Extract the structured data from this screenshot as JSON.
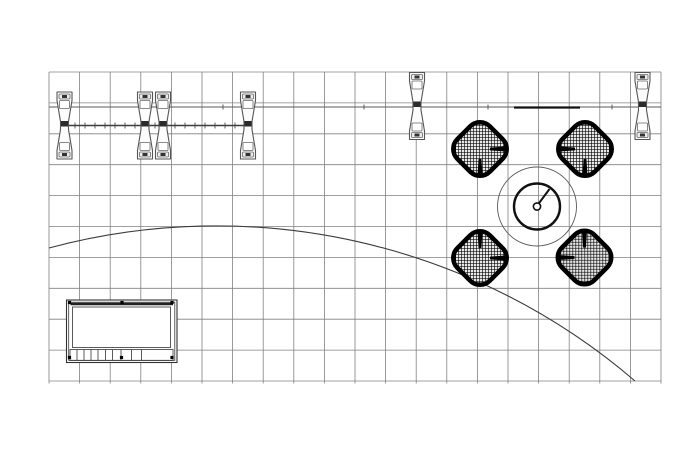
{
  "meta": {
    "type": "cad-floor-plan",
    "description": "Top view exhibit booth furniture plan on square grid",
    "background": "#ffffff"
  },
  "canvas": {
    "width": 700,
    "height": 450
  },
  "colors": {
    "grid": "#818181",
    "line": "#3c3c3c",
    "line_light": "#5a5a5a",
    "dark": "#111111",
    "fill": "#ffffff",
    "stool_fill": "#fcfcfc",
    "stool_inner": "#ececec",
    "mesh_bg": "#e8e8e8"
  },
  "grid": {
    "x": 49,
    "y": 72,
    "cols": 20,
    "rows": 10,
    "cell_w": 30.6,
    "cell_h": 30.9,
    "overhang": 2.5
  },
  "wall_line": {
    "y": 107,
    "x1": 49,
    "x2": 661,
    "ticks": [
      223,
      364,
      488,
      612
    ],
    "tick_h": 5
  },
  "counter_line": {
    "y": 125.5,
    "x1": 61,
    "x2": 249,
    "tick_start": 75,
    "tick_end": 245,
    "tick_step": 10,
    "tick_h": 6
  },
  "header_bar": {
    "y": 107.5,
    "x1": 514,
    "x2": 580
  },
  "stools": [
    {
      "cx": 64.5,
      "cy": 125.5
    },
    {
      "cx": 145,
      "cy": 125.5
    },
    {
      "cx": 163,
      "cy": 125.5
    },
    {
      "cx": 248,
      "cy": 125.5
    },
    {
      "cx": 417,
      "cy": 106
    },
    {
      "cx": 642.5,
      "cy": 106
    }
  ],
  "table": {
    "cx": 537,
    "cy": 206.5,
    "outer_r": 39.5,
    "inner_r": 23,
    "hub_r": 3.6,
    "hand_x2": 549.5,
    "hand_y2": 189
  },
  "lounge_chairs": [
    {
      "cx": 480,
      "cy": 149,
      "face_x": 1,
      "face_y": 1
    },
    {
      "cx": 585,
      "cy": 149,
      "face_x": -1,
      "face_y": 1
    },
    {
      "cx": 480,
      "cy": 258,
      "face_x": 1,
      "face_y": -1
    },
    {
      "cx": 584.5,
      "cy": 257.5,
      "face_x": -1,
      "face_y": -1
    }
  ],
  "cabinet": {
    "x": 66.5,
    "y": 300,
    "w": 110.5,
    "h": 62.5,
    "inner_inset": 2.2,
    "top_bar_y": 304,
    "panel": {
      "x": 72.5,
      "y": 307,
      "w": 98,
      "h": 40.5
    },
    "slat_strip": {
      "x": 70,
      "y": 349.5,
      "w": 103,
      "h": 11,
      "dividers": [
        77,
        84,
        91,
        98,
        105.5,
        112.5,
        121,
        131.5,
        141.5
      ]
    },
    "dot_y_top": 302.5,
    "dot_y_bottom": 357.5,
    "dots_top": [
      69.5,
      122,
      172
    ],
    "dots_bottom": [
      69.5,
      121.5,
      172
    ],
    "dot_size": 3.2
  },
  "arc": {
    "x1": 49,
    "y1": 248,
    "x2": 635,
    "y2": 381,
    "r": 643
  }
}
